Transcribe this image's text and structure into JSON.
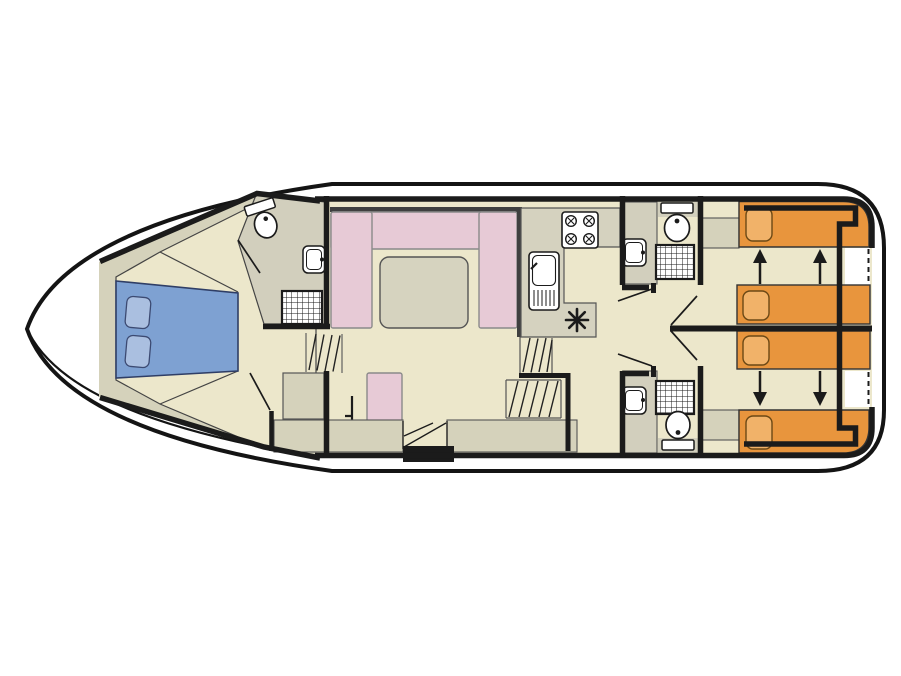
{
  "diagram": {
    "kind": "boat-deck-floor-plan",
    "view": "top-down",
    "bow_side": "left",
    "stern_side": "right"
  },
  "colors": {
    "hull": "#ffffff",
    "outline": "#141414",
    "wall": "#1b1b1b",
    "floor": "#ece7cb",
    "furniture": "#d5d2bb",
    "panel": "#d2cfbd",
    "counter": "#d5d2bf",
    "sofa_pink": "#e7cad6",
    "table": "#d6d3bf",
    "bed_blue": "#7ea1d2",
    "pillow_blue": "#aabfe0",
    "bed_orange": "#e8953d",
    "pillow_orange": "#f1b269",
    "fixture_white": "#ffffff",
    "accent_dark": "#3f3f3f"
  },
  "features": {
    "bow_cabin": {
      "bed": "double-bed",
      "pillow_count": 2
    },
    "bow_bathroom": {
      "fixtures": [
        "toilet",
        "washbasin",
        "shower"
      ]
    },
    "saloon": {
      "sofa": "u-shaped-sofa",
      "table": "dinette-table",
      "extra_seat": "side-seat"
    },
    "galley": {
      "hob_burners": 4,
      "fixtures": [
        "hob",
        "sink-with-drainer",
        "cool-box-star"
      ]
    },
    "bathroom_top": {
      "fixtures": [
        "toilet",
        "washbasin",
        "shower"
      ]
    },
    "bathroom_bottom": {
      "fixtures": [
        "toilet",
        "washbasin",
        "shower"
      ]
    },
    "stern_cabin_top": {
      "beds": 2,
      "convert_arrow_direction": "up",
      "arrow_count": 2
    },
    "stern_cabin_bottom": {
      "beds": 2,
      "convert_arrow_direction": "down",
      "arrow_count": 2
    },
    "stairs": {
      "bow_steps": 1,
      "mid_companionway_flights": 2
    }
  }
}
